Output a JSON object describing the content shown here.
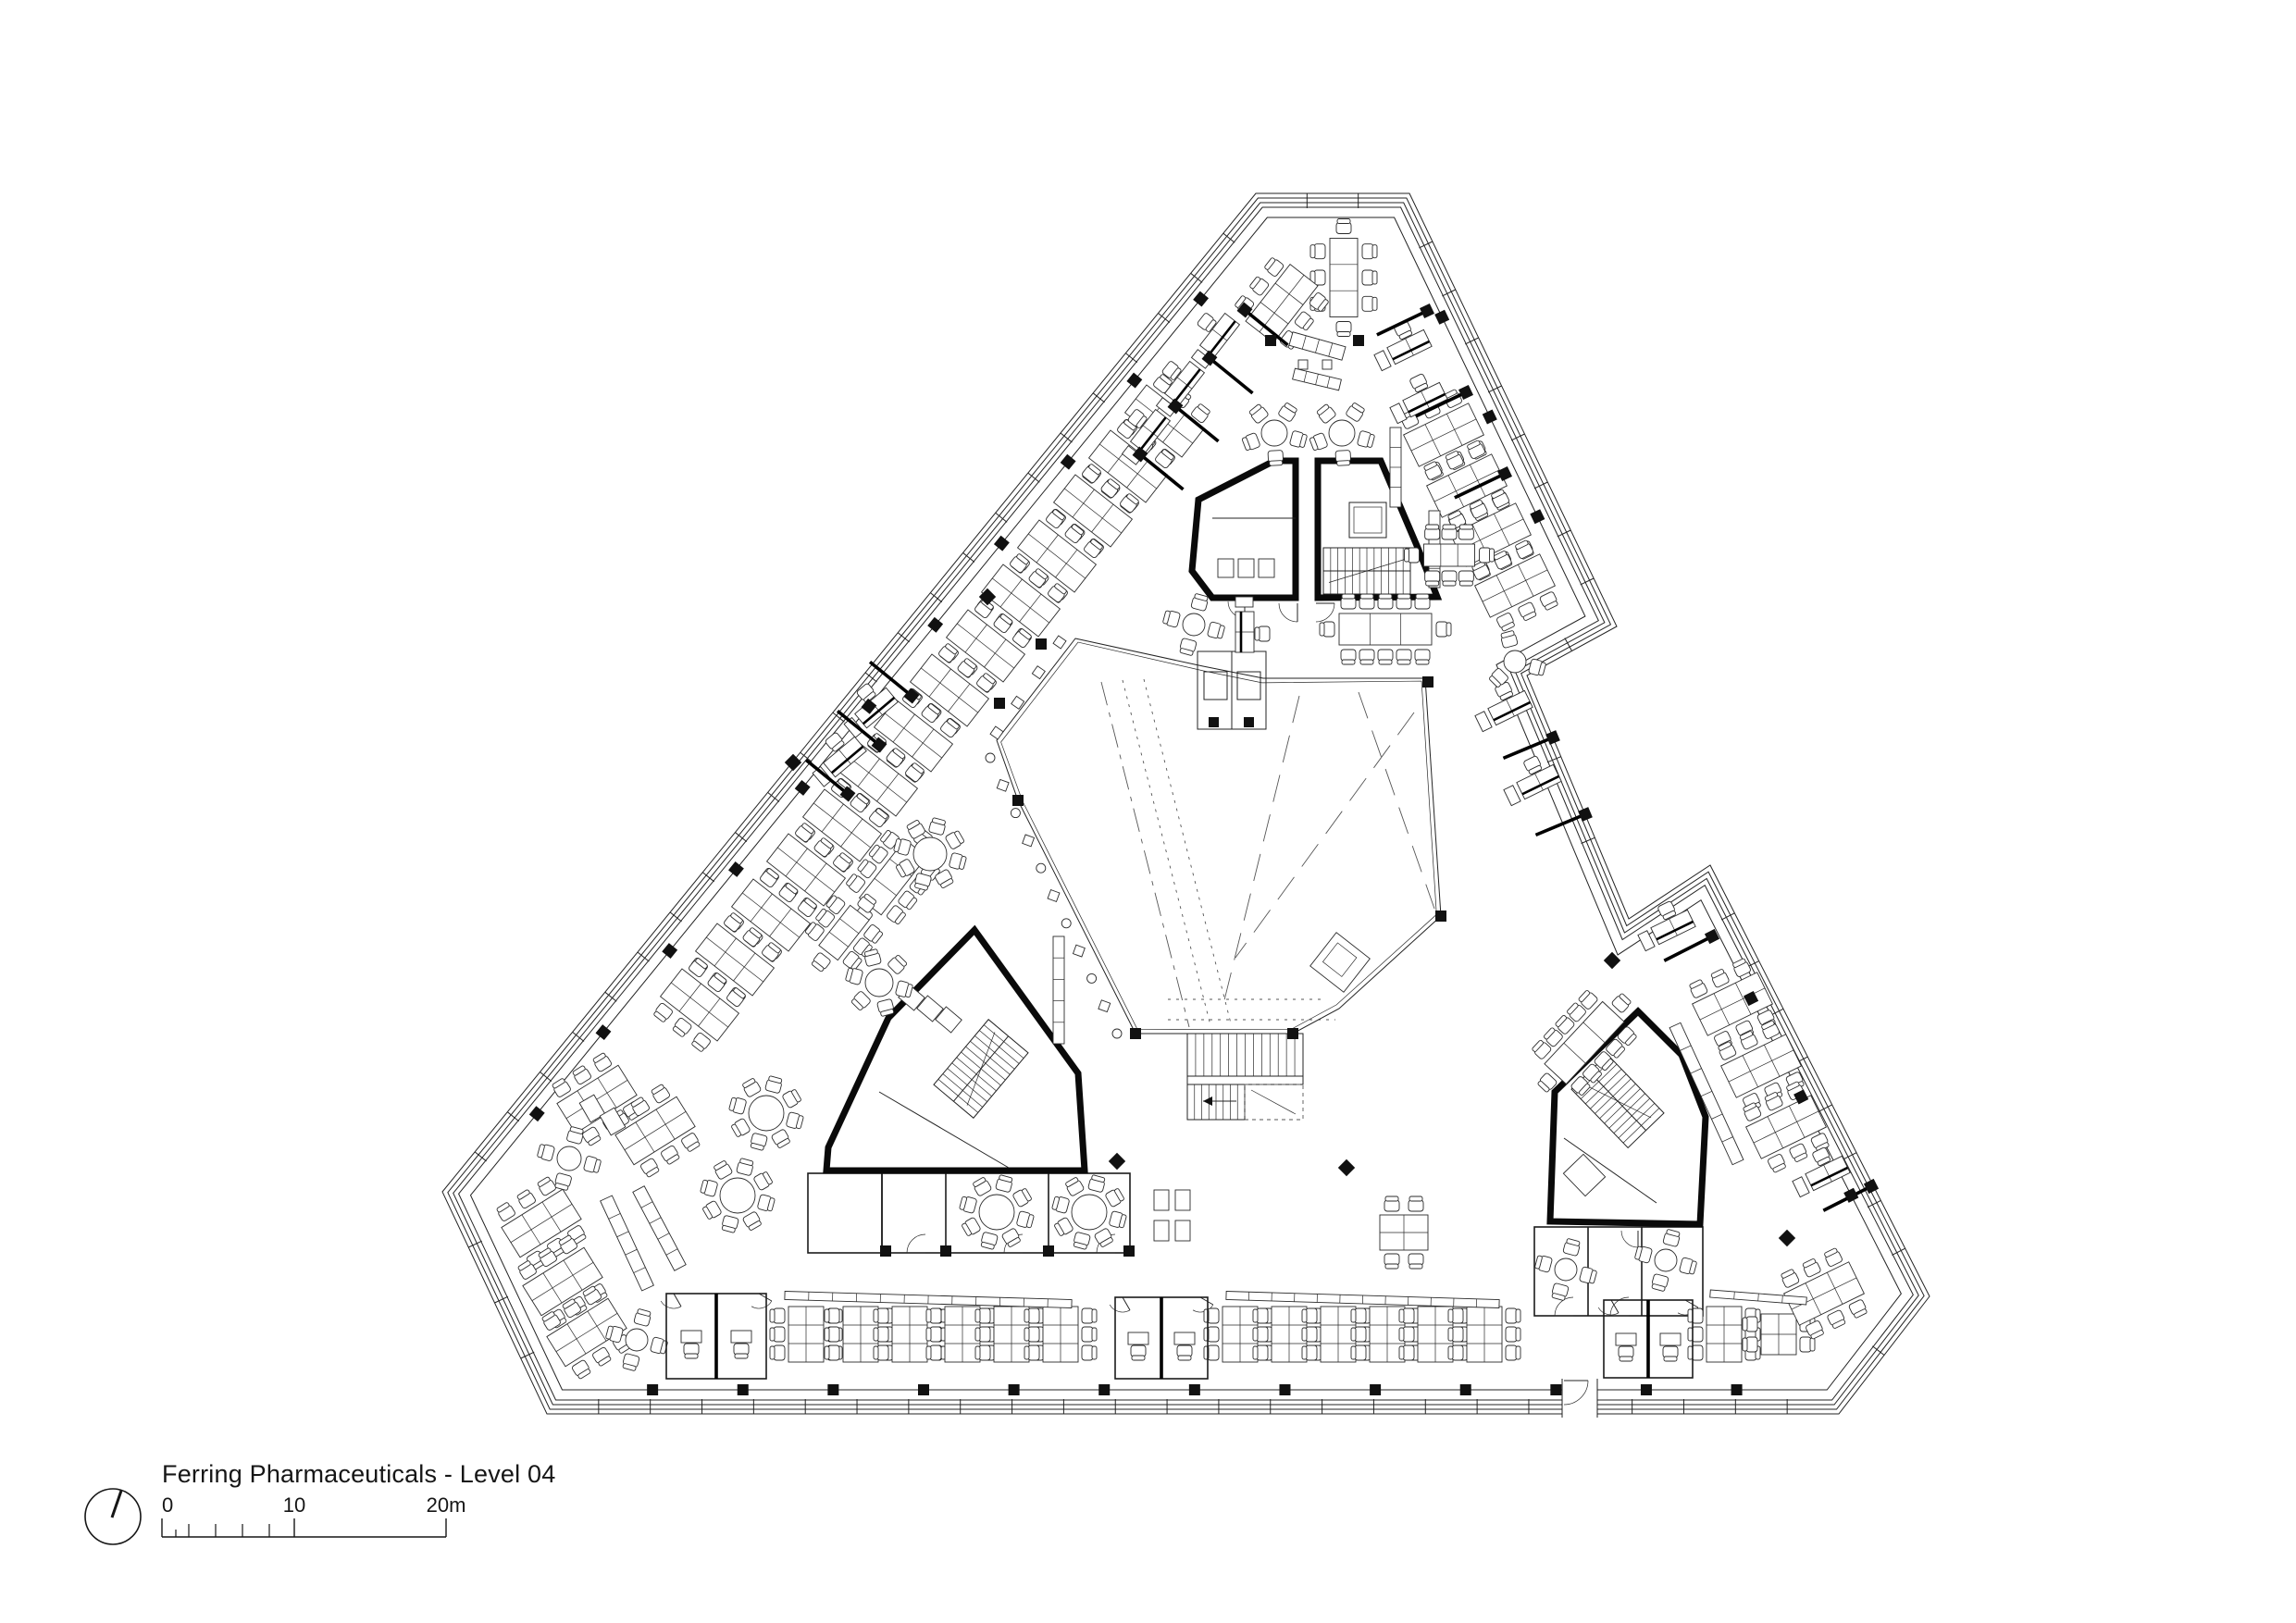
{
  "sheet": {
    "title": "Ferring Pharmaceuticals - Level 04",
    "background_color": "#ffffff",
    "ink_color": "#1c1c1c",
    "core_wall_color": "#0a0a0a"
  },
  "scale_bar": {
    "start_label": "0",
    "mid_label": "10",
    "end_label": "20m"
  },
  "icons": {
    "north_arrow": "north-arrow-icon"
  }
}
